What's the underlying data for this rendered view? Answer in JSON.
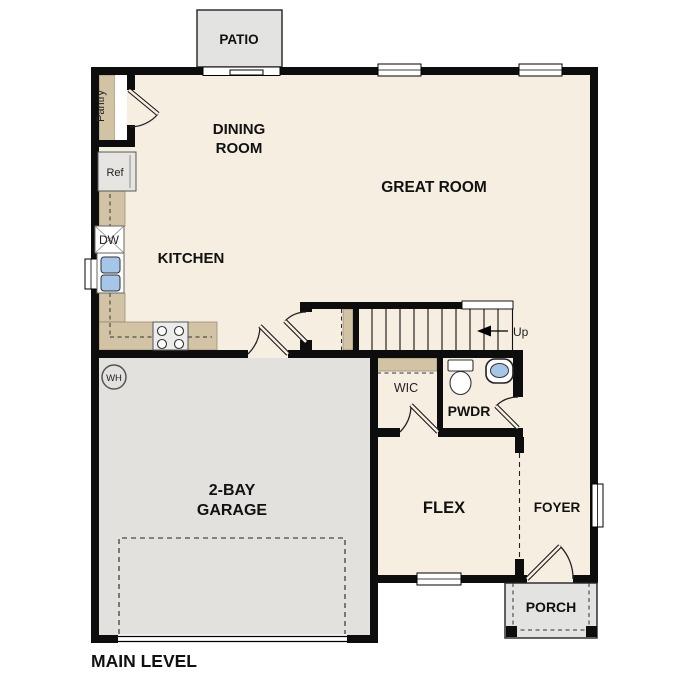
{
  "title": "MAIN LEVEL",
  "colors": {
    "floor": "#f7eee2",
    "garage": "#e2e1de",
    "tan": "#d2c3a5",
    "outdoor": "#e3e3e1",
    "wall": "#0d0d0d",
    "blue": "#a5c6e8",
    "text": "#111111"
  },
  "rooms": {
    "dining": {
      "line1": "DINING",
      "line2": "ROOM"
    },
    "great_room": {
      "label": "GREAT ROOM"
    },
    "kitchen": {
      "label": "KITCHEN"
    },
    "garage": {
      "line1": "2-BAY",
      "line2": "GARAGE"
    },
    "flex": {
      "label": "FLEX"
    },
    "foyer": {
      "label": "FOYER"
    },
    "pwdr": {
      "label": "PWDR"
    },
    "wic": {
      "label": "WIC"
    }
  },
  "outdoor_areas": {
    "patio": {
      "label": "PATIO"
    },
    "porch": {
      "label": "PORCH"
    }
  },
  "annotations": {
    "pantry": "Pantry",
    "ref": "Ref",
    "dishwasher": "DW",
    "water_heater": "WH",
    "stairs_up": "Up",
    "caption": "MAIN LEVEL"
  }
}
